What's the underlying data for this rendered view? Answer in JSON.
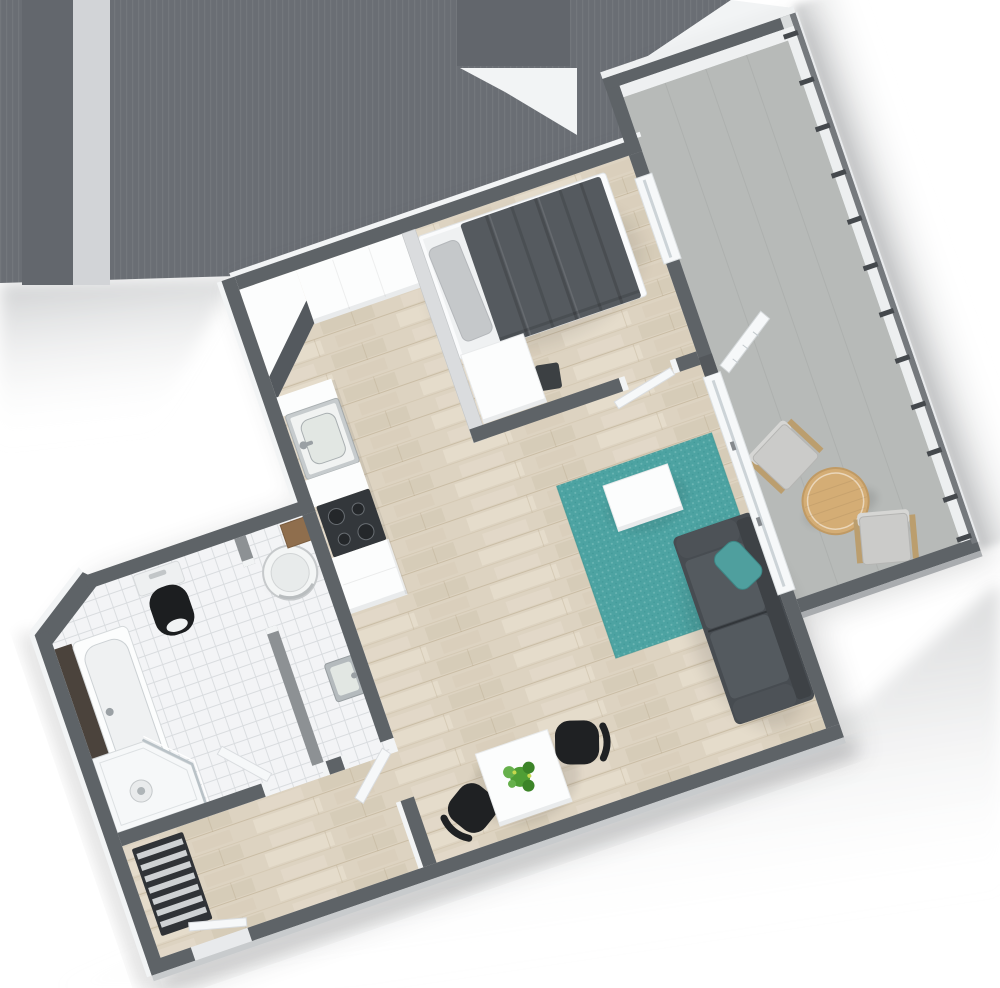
{
  "scene": {
    "type": "floor-plan-3d-render",
    "view": "top-down-isometric",
    "rotation_deg": -19,
    "text_labels": "none"
  },
  "rooms": [
    {
      "name": "bedroom",
      "floor": "wood",
      "furniture": [
        "double-bed",
        "gray-pillow",
        "dark-duvet",
        "desk",
        "desk-chair",
        "balcony-glass-door"
      ]
    },
    {
      "name": "kitchen",
      "floor": "wood",
      "furniture": [
        "l-shaped-counter",
        "corner-dark-worktop",
        "steel-sink",
        "faucet",
        "cooktop-4-burners",
        "base-cabinet"
      ]
    },
    {
      "name": "bathroom",
      "floor": "tile",
      "furniture": [
        "bathtub",
        "dark-wood-tub-panel",
        "corner-shower",
        "shower-stool",
        "toilet-black-seat",
        "door-leaf"
      ]
    },
    {
      "name": "wc-laundry",
      "floor": "tile",
      "furniture": [
        "washing-machine-round",
        "steel-hand-basin",
        "wood-shelf",
        "door-leaf"
      ]
    },
    {
      "name": "hallway",
      "floor": "wood",
      "furniture": [
        "radiator-slatted",
        "entry-door-leaf",
        "partition-stub"
      ]
    },
    {
      "name": "living-room",
      "floor": "wood",
      "furniture": [
        "teal-rug",
        "white-coffee-table",
        "charcoal-sofa",
        "teal-cushion",
        "dining-table",
        "plant",
        "black-chair-left",
        "black-chair-right",
        "open-balcony-door"
      ]
    },
    {
      "name": "balcony",
      "floor": "concrete",
      "furniture": [
        "round-wood-table",
        "outdoor-chair-north",
        "outdoor-chair-south",
        "glass-railing",
        "parapet-wall"
      ]
    }
  ],
  "colors": {
    "page_bg": "#ffffff",
    "mass": "#6a6e74",
    "mass_band_light": "#d2d4d7",
    "mass_band_dark": "#63676d",
    "mass_block": "#62666c",
    "wall_top": "#5e6367",
    "wall_top_light": "#dadcde",
    "wall_lit": "#f2f4f5",
    "wall_face_shade": "#9b9ea1",
    "divider": "#8d9194",
    "wood": "#ddd3c1",
    "wood_streak_light": "#ebe3d3",
    "wood_streak_dark": "#cfc4ad",
    "wood_line": "#b3a284",
    "tile": "#f3f4f6",
    "tile_line": "#d9dcdf",
    "balcony_floor": "#b7bab8",
    "parapet_light": "#eef0f1",
    "rail": "#75797d",
    "rail_post": "#45494d",
    "rail_glass": "#eef1f2",
    "rug": "#4da3a2",
    "rug_dot": "#85c4c3",
    "sofa": "#474c51",
    "sofa_seat": "#545a5f",
    "sofa_back": "#3e4246",
    "sofa_arm": "#4d5257",
    "teal_pillow": "#4f9f9e",
    "duvet": "#555a5f",
    "pillow": "#c5c8ca",
    "bed_frame": "#fafbfc",
    "mattress": "#eff1f2",
    "white_furn": "#fcfdfd",
    "furn_face": "#e9ebec",
    "counter_dark": "#54595e",
    "cooktop": "#33373b",
    "burner": "#24272a",
    "steel": "#b4babd",
    "steel_frame": "#c6cbcd",
    "basin": "#e2e7e3",
    "chrome": "#9aa0a4",
    "chair_black": "#1f2123",
    "table_wood": "#d4ad75",
    "table_wood_edge": "#c09a64",
    "out_chair": "#cbcbc9",
    "out_chair_wood": "#bb9e6e",
    "toilet_black": "#1c1e20",
    "tub_panel": "#4b433c",
    "radiator_dark": "#303337",
    "radiator_light": "#ced1d3",
    "door": "#f6f8f9",
    "glass_line": "#ccd3d7",
    "plant": "#4f9e35",
    "plant_dark": "#3c8428",
    "plant_light": "#66b04b",
    "brown_board": "#8f6e4d",
    "shadow_face": "#c8cbcd"
  }
}
